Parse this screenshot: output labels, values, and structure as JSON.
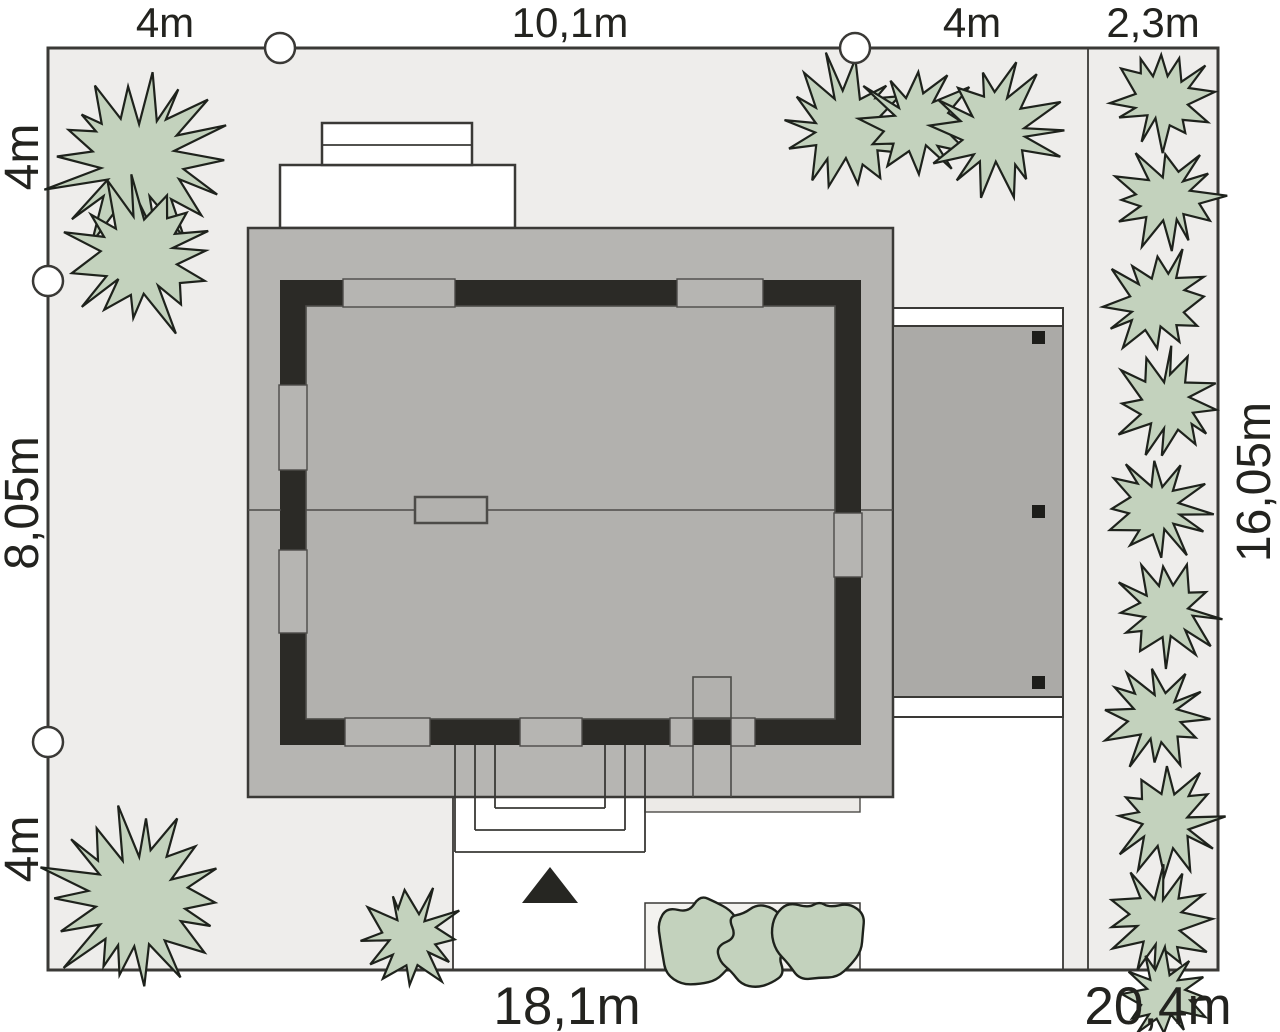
{
  "dimensions": {
    "top": [
      "4m",
      "10,1m",
      "4m",
      "2,3m"
    ],
    "left": [
      "4m",
      "8,05m",
      "4m"
    ],
    "right": [
      "16,05m"
    ],
    "bottom": [
      "18,1m",
      "20,4m"
    ]
  },
  "colors": {
    "plot_fill": "#eeedeb",
    "line": "#3a3936",
    "roof_fill": "#b6b5b2",
    "wall_fill": "#2b2a26",
    "interior_fill": "#b2b1ae",
    "terrace_fill": "#abaaa7",
    "driveway_fill": "#ffffff",
    "plant_fill": "#c3d2bd",
    "plant_stroke": "#1e221c",
    "label_color": "#23231f"
  },
  "plants": {
    "trees": [
      {
        "cx": 138,
        "cy": 160,
        "r": 97,
        "seed": 11
      },
      {
        "cx": 143,
        "cy": 256,
        "r": 83,
        "seed": 23
      },
      {
        "cx": 846,
        "cy": 127,
        "r": 77,
        "seed": 35
      },
      {
        "cx": 917,
        "cy": 123,
        "r": 64,
        "seed": 47
      },
      {
        "cx": 996,
        "cy": 132,
        "r": 75,
        "seed": 59
      },
      {
        "cx": 136,
        "cy": 899,
        "r": 101,
        "seed": 71
      },
      {
        "cx": 410,
        "cy": 937,
        "r": 55,
        "seed": 83
      }
    ],
    "hedge_row": [
      {
        "cx": 1161,
        "cy": 97,
        "r": 57,
        "seed": 101
      },
      {
        "cx": 1168,
        "cy": 199,
        "r": 59,
        "seed": 103
      },
      {
        "cx": 1157,
        "cy": 301,
        "r": 57,
        "seed": 105
      },
      {
        "cx": 1167,
        "cy": 404,
        "r": 59,
        "seed": 107
      },
      {
        "cx": 1158,
        "cy": 508,
        "r": 58,
        "seed": 109
      },
      {
        "cx": 1166,
        "cy": 612,
        "r": 59,
        "seed": 111
      },
      {
        "cx": 1157,
        "cy": 716,
        "r": 57,
        "seed": 113
      },
      {
        "cx": 1166,
        "cy": 820,
        "r": 59,
        "seed": 115
      },
      {
        "cx": 1159,
        "cy": 922,
        "r": 57,
        "seed": 117
      },
      {
        "cx": 1164,
        "cy": 995,
        "r": 48,
        "seed": 119
      }
    ],
    "shrubs": [
      {
        "cx": 700,
        "cy": 940,
        "r": 48,
        "seed": 201
      },
      {
        "cx": 757,
        "cy": 946,
        "r": 41,
        "seed": 203
      },
      {
        "cx": 819,
        "cy": 933,
        "r": 50,
        "seed": 205
      }
    ]
  },
  "markers": {
    "boundary_circles": [
      {
        "cx": 280,
        "cy": 48
      },
      {
        "cx": 855,
        "cy": 48
      },
      {
        "cx": 48,
        "cy": 281
      },
      {
        "cx": 48,
        "cy": 742
      }
    ],
    "radius": 15
  }
}
